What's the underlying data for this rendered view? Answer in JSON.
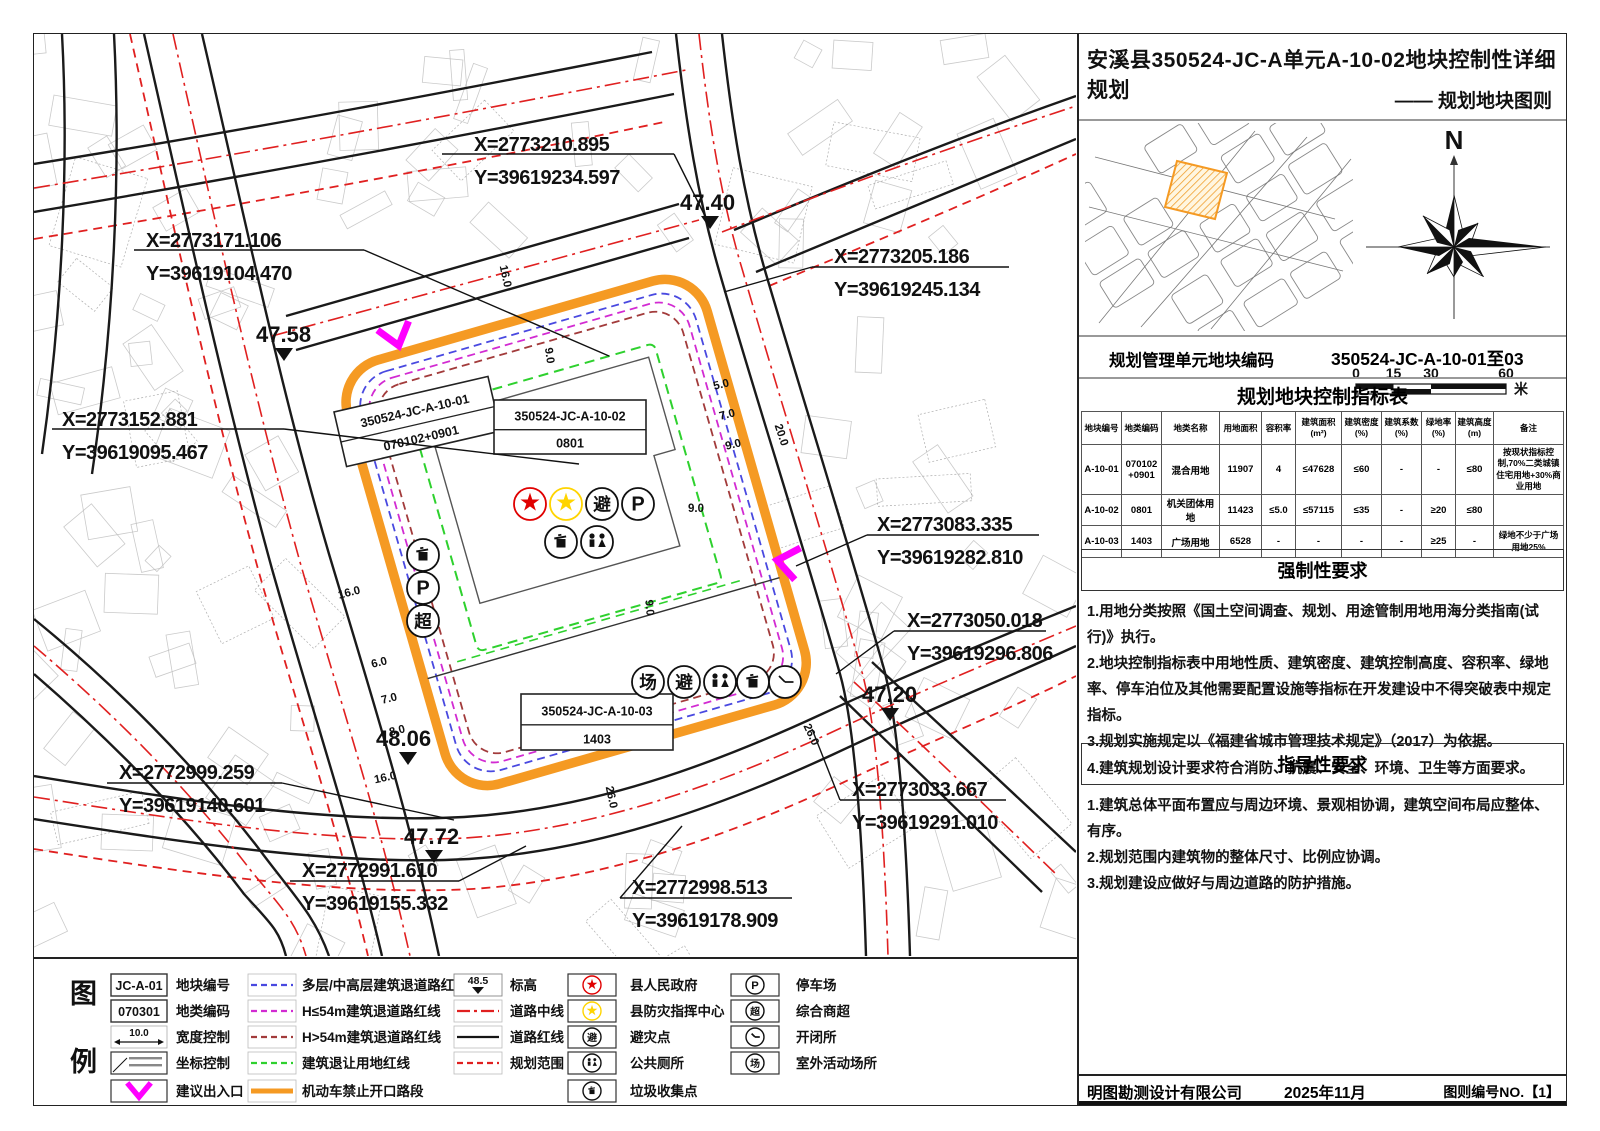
{
  "title": "安溪县350524-JC-A单元A-10-02地块控制性详细规划",
  "subtitle": "—— 规划地块图则",
  "locator": {
    "north_label": "N",
    "scale_ticks": [
      "0",
      "15",
      "30",
      "60"
    ],
    "scale_tick_px": [
      22,
      59.5,
      97,
      172
    ],
    "scale_unit": "米"
  },
  "unit_code": {
    "label": "规划管理单元地块编码",
    "value": "350524-JC-A-10-01至03"
  },
  "indicator_table": {
    "title": "规划地块控制指标表",
    "headers": [
      "地块编号",
      "地类编码",
      "地类名称",
      "用地面积",
      "容积率",
      "建筑面积\n(m²)",
      "建筑密度\n(%)",
      "建筑系数\n(%)",
      "绿地率\n(%)",
      "建筑高度\n(m)",
      "备注"
    ],
    "col_px": [
      40,
      40,
      58,
      42,
      34,
      46,
      40,
      40,
      34,
      38,
      70
    ],
    "rows": [
      [
        "A-10-01",
        "070102\n+0901",
        "混合用地",
        "11907",
        "4",
        "≤47628",
        "≤60",
        "-",
        "-",
        "≤80",
        "按现状指标控制,70%二类城镇住宅用地+30%商业用地"
      ],
      [
        "A-10-02",
        "0801",
        "机关团体用地",
        "11423",
        "≤5.0",
        "≤57115",
        "≤35",
        "-",
        "≥20",
        "≤80",
        ""
      ],
      [
        "A-10-03",
        "1403",
        "广场用地",
        "6528",
        "-",
        "-",
        "-",
        "-",
        "≥25",
        "-",
        "绿地不少于广场用地25%"
      ]
    ]
  },
  "mandatory": {
    "title": "强制性要求",
    "items": [
      "1.用地分类按照《国土空间调查、规划、用途管制用地用海分类指南(试行)》执行。",
      "2.地块控制指标表中用地性质、建筑密度、建筑控制高度、容积率、绿地率、停车泊位及其他需要配置设施等指标在开发建设中不得突破表中规定指标。",
      "3.规划实施规定以《福建省城市管理技术规定》（2017）为依据。",
      "4.建筑规划设计要求符合消防、抗震、安全、环境、卫生等方面要求。"
    ]
  },
  "guidance": {
    "title": "指导性要求",
    "items": [
      "1.建筑总体平面布置应与周边环境、景观相协调，建筑空间布局应整体、有序。",
      "2.规划范围内建筑物的整体尺寸、比例应协调。",
      "3.规划建设应做好与周边道路的防护措施。"
    ]
  },
  "footer": {
    "company": "明图勘测设计有限公司",
    "date": "2025年11月",
    "sheet_no": "图则编号NO.【1】"
  },
  "colors": {
    "orange": "#f59a23",
    "magenta_line": "#d22bd2",
    "blue_line": "#4949e0",
    "darkred_line": "#a23b3b",
    "green_line": "#2ed12e",
    "road_red": "#e02020",
    "road_black": "#1a1a1a",
    "entrance_magenta": "#ff00ff",
    "gov_star": "#e00000",
    "disaster_star": "#ffd400"
  },
  "legend": {
    "heading": [
      "图",
      "例"
    ],
    "columns": [
      {
        "x": 77,
        "label_x": 142,
        "items": [
          {
            "type": "code-box",
            "text": "JC-A-01",
            "label": "地块编号"
          },
          {
            "type": "code-box",
            "text": "070301",
            "label": "地类编码"
          },
          {
            "type": "width-arrow",
            "text": "10.0",
            "label": "宽度控制"
          },
          {
            "type": "coord-box",
            "label": "坐标控制"
          },
          {
            "type": "chevron",
            "label": "建议出入口"
          }
        ]
      },
      {
        "x": 214,
        "label_x": 268,
        "items": [
          {
            "type": "line",
            "style": "dashed",
            "color": "#4949e0",
            "label": "多层/中高层建筑退道路红线"
          },
          {
            "type": "line",
            "style": "dashed",
            "color": "#d22bd2",
            "label": "H≤54m建筑退道路红线"
          },
          {
            "type": "line",
            "style": "dashed",
            "color": "#a23b3b",
            "label": "H>54m建筑退道路红线"
          },
          {
            "type": "line",
            "style": "dashed",
            "color": "#2ed12e",
            "label": "建筑退让用地红线"
          },
          {
            "type": "line",
            "style": "thick",
            "color": "#f59a23",
            "label": "机动车禁止开口路段"
          }
        ]
      },
      {
        "x": 420,
        "label_x": 476,
        "items": [
          {
            "type": "elevation",
            "text": "48.5",
            "label": "标高"
          },
          {
            "type": "line",
            "style": "dashdot",
            "color": "#e02020",
            "label": "道路中线"
          },
          {
            "type": "line",
            "style": "solid",
            "color": "#151515",
            "label": "道路红线"
          },
          {
            "type": "line",
            "style": "dashed",
            "color": "#e02020",
            "label": "规划范围"
          }
        ]
      },
      {
        "x": 534,
        "label_x": 596,
        "items": [
          {
            "type": "circle-icon",
            "icon": "star",
            "color": "#e00000",
            "label": "县人民政府"
          },
          {
            "type": "circle-icon",
            "icon": "star",
            "color": "#ffd400",
            "label": "县防灾指挥中心"
          },
          {
            "type": "circle-icon",
            "icon": "char",
            "char": "避",
            "label": "避灾点"
          },
          {
            "type": "circle-icon",
            "icon": "toilet",
            "label": "公共厕所"
          },
          {
            "type": "circle-icon",
            "icon": "trash",
            "label": "垃圾收集点"
          }
        ]
      },
      {
        "x": 697,
        "label_x": 762,
        "items": [
          {
            "type": "circle-icon",
            "icon": "char",
            "char": "P",
            "label": "停车场"
          },
          {
            "type": "circle-icon",
            "icon": "char",
            "char": "超",
            "label": "综合商超"
          },
          {
            "type": "circle-icon",
            "icon": "clock",
            "label": "开闭所"
          },
          {
            "type": "circle-icon",
            "icon": "char",
            "char": "场",
            "label": "室外活动场所"
          }
        ]
      }
    ]
  },
  "map": {
    "coordinate_labels": [
      {
        "x": 440,
        "y": 104,
        "line1": "X=2773210.895",
        "line2": "Y=39619234.597",
        "ux1": 408,
        "uy": 120,
        "ux2": 640,
        "tx": 676,
        "ty": 192
      },
      {
        "x": 112,
        "y": 200,
        "line1": "X=2773171.106",
        "line2": "Y=39619104.470",
        "ux1": 100,
        "uy": 216,
        "ux2": 330,
        "tx": 575,
        "ty": 322
      },
      {
        "x": 28,
        "y": 379,
        "line1": "X=2773152.881",
        "line2": "Y=39619095.467",
        "ux1": 18,
        "uy": 395,
        "ux2": 250,
        "tx": 545,
        "ty": 430
      },
      {
        "x": 800,
        "y": 216,
        "line1": "X=2773205.186",
        "line2": "Y=39619245.134",
        "ux1": 778,
        "uy": 233,
        "ux2": 975,
        "tx": 690,
        "ty": 258
      },
      {
        "x": 843,
        "y": 484,
        "line1": "X=2773083.335",
        "line2": "Y=39619282.810",
        "ux1": 833,
        "uy": 501,
        "ux2": 1005,
        "tx": 762,
        "ty": 532
      },
      {
        "x": 873,
        "y": 580,
        "line1": "X=2773050.018",
        "line2": "Y=39619296.806",
        "ux1": 860,
        "uy": 597,
        "ux2": 1012,
        "tx": 802,
        "ty": 640
      },
      {
        "x": 818,
        "y": 749,
        "line1": "X=2773033.667",
        "line2": "Y=39619291.010",
        "ux1": 806,
        "uy": 766,
        "ux2": 972,
        "tx": 778,
        "ty": 695
      },
      {
        "x": 85,
        "y": 732,
        "line1": "X=2772999.259",
        "line2": "Y=39619140.601",
        "ux1": 73,
        "uy": 749,
        "ux2": 248,
        "tx": 420,
        "ty": 786
      },
      {
        "x": 268,
        "y": 830,
        "line1": "X=2772991.610",
        "line2": "Y=39619155.332",
        "ux1": 256,
        "uy": 847,
        "ux2": 425,
        "tx": 492,
        "ty": 812
      },
      {
        "x": 598,
        "y": 847,
        "line1": "X=2772998.513",
        "line2": "Y=39619178.909",
        "ux1": 586,
        "uy": 864,
        "ux2": 758,
        "tx": 648,
        "ty": 792
      }
    ],
    "elevation_labels": [
      {
        "x": 646,
        "y": 168,
        "tx": 676,
        "ty": 192,
        "value": "47.40"
      },
      {
        "x": 222,
        "y": 300,
        "tx": 250,
        "ty": 324,
        "value": "47.58"
      },
      {
        "x": 342,
        "y": 704,
        "tx": 374,
        "ty": 728,
        "value": "48.06"
      },
      {
        "x": 370,
        "y": 802,
        "tx": 400,
        "ty": 826,
        "value": "47.72"
      },
      {
        "x": 828,
        "y": 660,
        "tx": 856,
        "ty": 684,
        "value": "47.20"
      }
    ],
    "parcel_labels": [
      {
        "x": 300,
        "y": 378,
        "w": 158,
        "h": 56,
        "rot": -13,
        "code": "350524-JC-A-10-01",
        "cls": "070102+0901"
      },
      {
        "x": 460,
        "y": 366,
        "w": 152,
        "h": 54,
        "rot": 0,
        "code": "350524-JC-A-10-02",
        "cls": "0801"
      },
      {
        "x": 487,
        "y": 660,
        "w": 152,
        "h": 56,
        "rot": 0,
        "code": "350524-JC-A-10-03",
        "cls": "1403"
      }
    ],
    "dimensions": [
      {
        "x": 468,
        "y": 243,
        "rot": 78,
        "value": "16.0"
      },
      {
        "x": 512,
        "y": 322,
        "rot": 82,
        "value": "9.0"
      },
      {
        "x": 688,
        "y": 354,
        "rot": -14,
        "value": "5.0"
      },
      {
        "x": 694,
        "y": 384,
        "rot": -14,
        "value": "7.0"
      },
      {
        "x": 700,
        "y": 414,
        "rot": -14,
        "value": "9.0"
      },
      {
        "x": 744,
        "y": 402,
        "rot": 72,
        "value": "20.0"
      },
      {
        "x": 662,
        "y": 478,
        "rot": 0,
        "value": "9.0"
      },
      {
        "x": 612,
        "y": 574,
        "rot": 85,
        "value": "9.0"
      },
      {
        "x": 316,
        "y": 562,
        "rot": -14,
        "value": "16.0"
      },
      {
        "x": 346,
        "y": 632,
        "rot": -14,
        "value": "6.0"
      },
      {
        "x": 356,
        "y": 668,
        "rot": -14,
        "value": "7.0"
      },
      {
        "x": 364,
        "y": 700,
        "rot": -14,
        "value": "8.0"
      },
      {
        "x": 352,
        "y": 747,
        "rot": -12,
        "value": "16.0"
      },
      {
        "x": 574,
        "y": 764,
        "rot": 78,
        "value": "26.0"
      },
      {
        "x": 774,
        "y": 702,
        "rot": 65,
        "value": "26.0"
      }
    ],
    "site_icons": [
      {
        "x": 496,
        "y": 470,
        "icon": "star",
        "color": "#e00000"
      },
      {
        "x": 532,
        "y": 470,
        "icon": "star",
        "color": "#ffd400"
      },
      {
        "x": 568,
        "y": 470,
        "icon": "char",
        "char": "避"
      },
      {
        "x": 604,
        "y": 470,
        "icon": "char",
        "char": "P"
      },
      {
        "x": 527,
        "y": 508,
        "icon": "trash"
      },
      {
        "x": 563,
        "y": 508,
        "icon": "toilet"
      },
      {
        "x": 614,
        "y": 648,
        "icon": "char",
        "char": "场"
      },
      {
        "x": 650,
        "y": 648,
        "icon": "char",
        "char": "避"
      },
      {
        "x": 686,
        "y": 648,
        "icon": "toilet"
      },
      {
        "x": 719,
        "y": 648,
        "icon": "trash"
      },
      {
        "x": 751,
        "y": 648,
        "icon": "clock"
      },
      {
        "x": 389,
        "y": 521,
        "icon": "trash"
      },
      {
        "x": 389,
        "y": 554,
        "icon": "char",
        "char": "P"
      },
      {
        "x": 389,
        "y": 587,
        "icon": "char",
        "char": "超"
      }
    ],
    "entrances": [
      {
        "x": 362,
        "y": 302,
        "rot": -16
      },
      {
        "x": 753,
        "y": 528,
        "rot": 100
      }
    ]
  }
}
